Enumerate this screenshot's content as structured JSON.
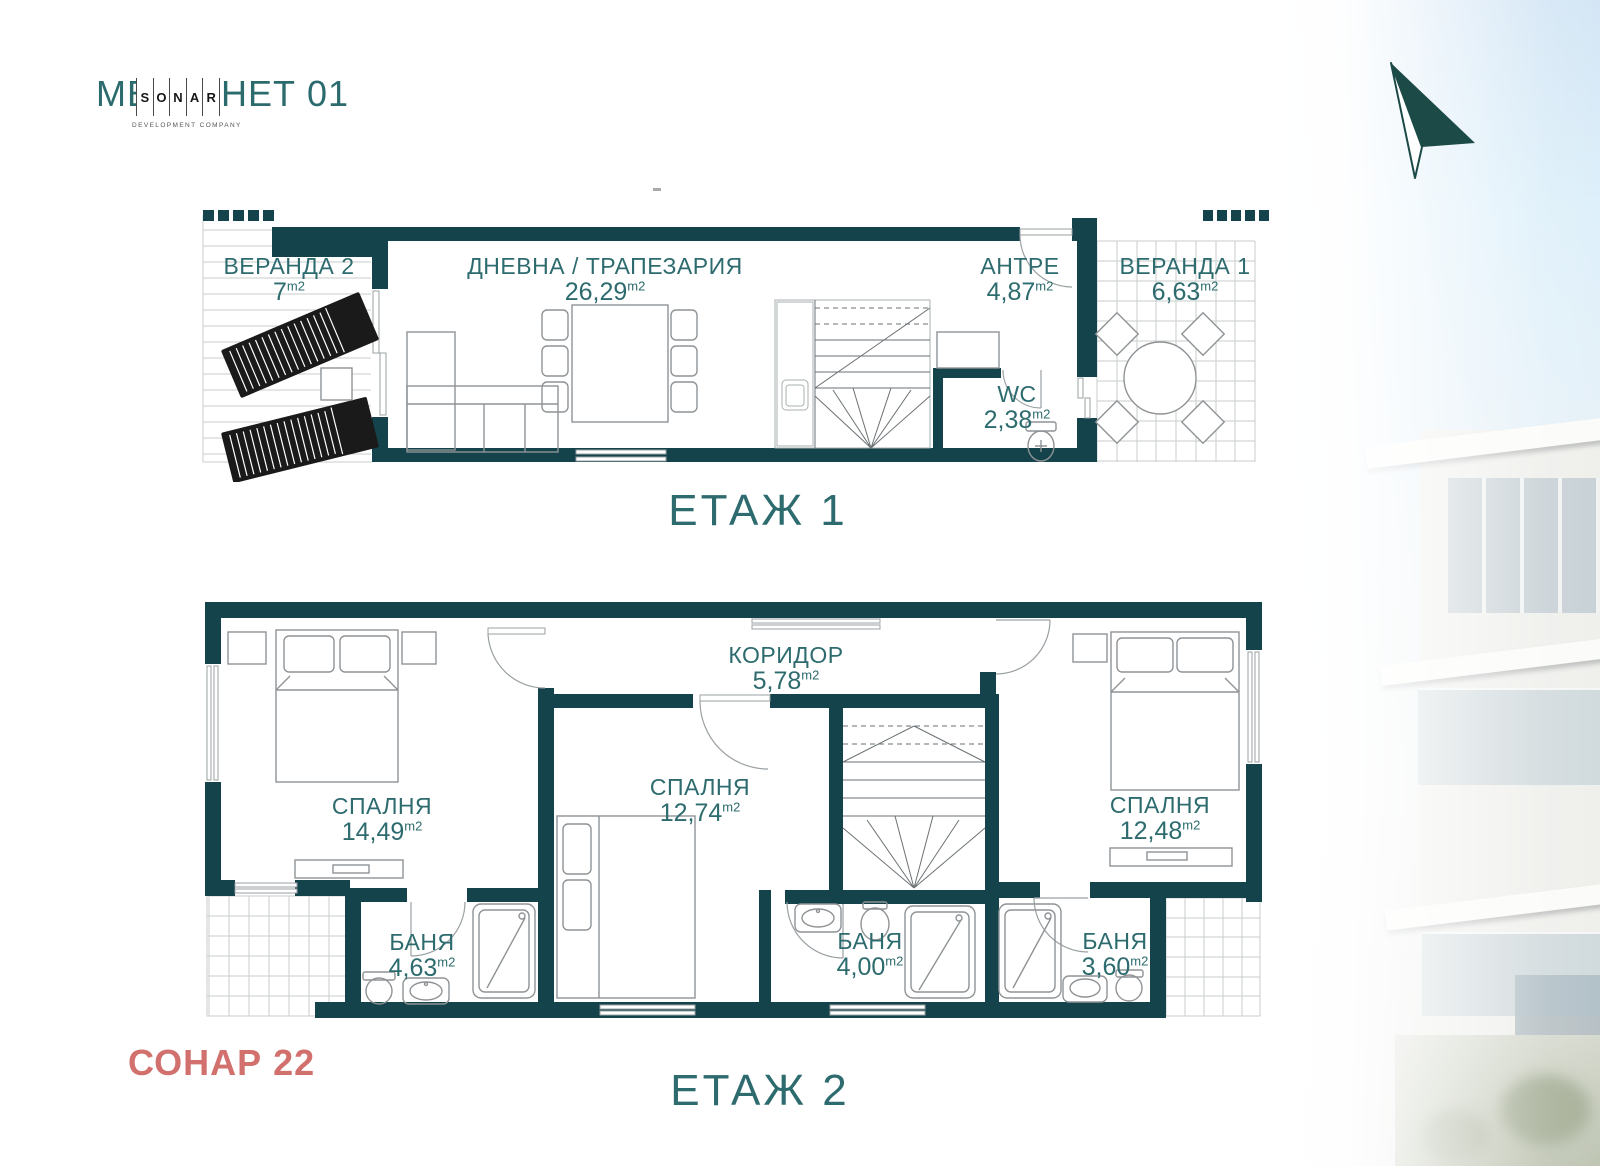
{
  "logo": {
    "brand_left": "МЕ",
    "brand_right": "НЕТ 01",
    "sonar_letters": [
      "S",
      "O",
      "N",
      "A",
      "R"
    ],
    "tagline": "DEVELOPMENT COMPANY"
  },
  "watermark": "СОНАР 22",
  "area_unit": "m2",
  "floor1": {
    "title": "ЕТАЖ 1",
    "rooms": {
      "veranda2": {
        "name": "ВЕРАНДА 2",
        "area": "7"
      },
      "living": {
        "name": "ДНЕВНА / ТРАПЕЗАРИЯ",
        "area": "26,29"
      },
      "antre": {
        "name": "АНТРЕ",
        "area": "4,87"
      },
      "wc": {
        "name": "WC",
        "area": "2,38"
      },
      "veranda1": {
        "name": "ВЕРАНДА 1",
        "area": "6,63"
      }
    }
  },
  "floor2": {
    "title": "ЕТАЖ 2",
    "rooms": {
      "corridor": {
        "name": "КОРИДОР",
        "area": "5,78"
      },
      "bedroom1": {
        "name": "СПАЛНЯ",
        "area": "14,49"
      },
      "bedroom2": {
        "name": "СПАЛНЯ",
        "area": "12,74"
      },
      "bedroom3": {
        "name": "СПАЛНЯ",
        "area": "12,48"
      },
      "bath1": {
        "name": "БАНЯ",
        "area": "4,63"
      },
      "bath2": {
        "name": "БАНЯ",
        "area": "4,00"
      },
      "bath3": {
        "name": "БАНЯ",
        "area": "3,60"
      }
    }
  },
  "colors": {
    "wall": "#14434b",
    "label": "#2d6b6e",
    "accent_red": "#d2706e"
  }
}
